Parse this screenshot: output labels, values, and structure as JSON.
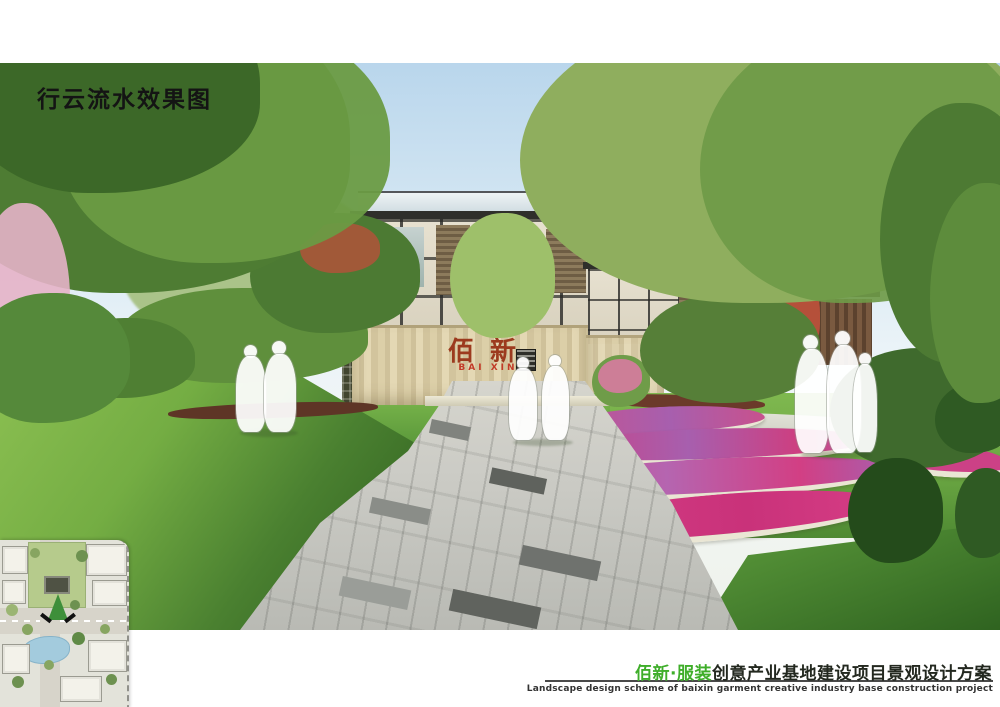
{
  "page": {
    "title": "行云流水效果图",
    "background_color": "#ffffff"
  },
  "rendering": {
    "description": "landscape entrance perspective rendering with lawns, wavy flower beds, stone gateway wall, modern buildings and figure silhouettes",
    "entrance_sign": {
      "calligraphy": "佰新",
      "latin": "BAI XIN",
      "calligraphy_color": "#9c3a1e",
      "latin_color": "#c23b28",
      "wall_color": "#d8cba6"
    },
    "palette": {
      "sky": "#b9d6ec",
      "lawn_bright": "#8cc052",
      "lawn_dark": "#2a5a1c",
      "flower_magenta": "#d63d85",
      "flower_purple": "#a75fae",
      "flower_edging": "#eae6d4",
      "paving_light": "#d9d8d0",
      "paving_dark": "#5f625d",
      "hedge_brown": "#5e3526",
      "blossom_pink": "#e5b3c8"
    }
  },
  "site_plan": {
    "description": "master plan inset with view-direction arrow, buildings, roads, pond and lawn",
    "arrow_color": "#3e8f3a",
    "pond_color": "#a3cbdd",
    "lawn_color": "#b6cb8c"
  },
  "footer": {
    "project_name_highlight": "佰新·服装",
    "project_name_rest": "创意产业基地建设项目景观设计方案",
    "subtitle_en": "Landscape design scheme of baixin garment creative industry base construction project",
    "highlight_color": "#3fae2a",
    "text_color": "#23281f"
  }
}
